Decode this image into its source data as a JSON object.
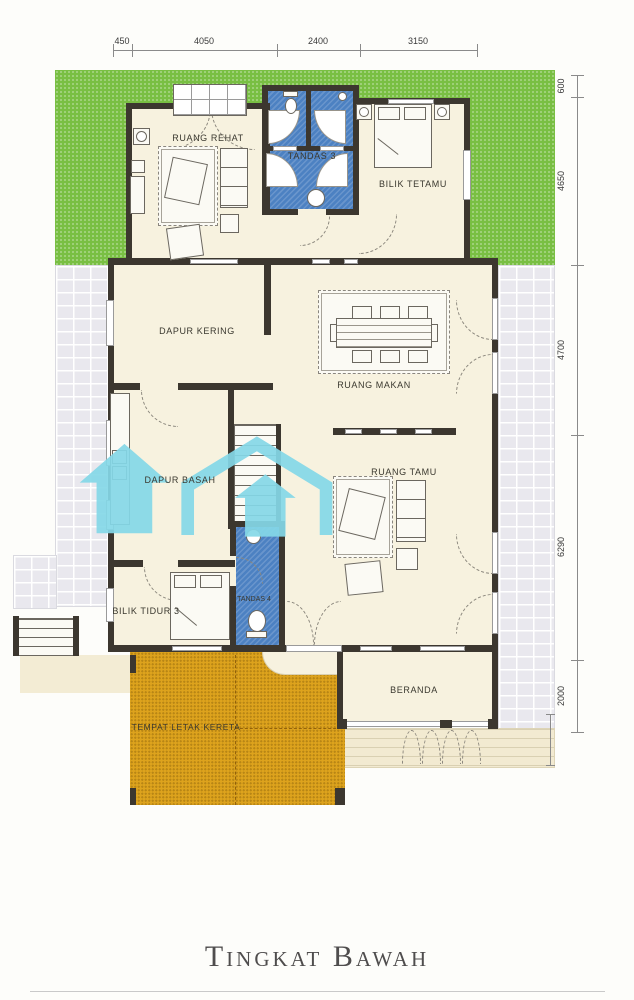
{
  "title": "Tingkat Bawah",
  "dimensions": {
    "top": [
      "450",
      "4050",
      "2400",
      "3150"
    ],
    "right": [
      "600",
      "4650",
      "4700",
      "6290",
      "2000"
    ]
  },
  "rooms": {
    "ruang_rehat": "RUANG REHAT",
    "tandas_3": "TANDAS 3",
    "bilik_tetamu": "BILIK TETAMU",
    "dapur_kering": "DAPUR KERING",
    "ruang_makan": "RUANG MAKAN",
    "dapur_basah": "DAPUR BASAH",
    "ruang_tamu": "RUANG TAMU",
    "bilik_tidur_3": "BILIK TIDUR 3",
    "tandas_4": "TANDAS 4",
    "beranda": "BERANDA",
    "tempat_letak_kereta": "TEMPAT LETAK KERETA"
  },
  "colors": {
    "wall": "#3c372f",
    "lawn": "#79bf43",
    "floor": "#f7f2df",
    "bathroom": "#4c81c2",
    "carpark": "#dda31d",
    "tiles": "#e9e8ee",
    "planks": "#f2ead1",
    "watermark": "#85d8e8"
  }
}
